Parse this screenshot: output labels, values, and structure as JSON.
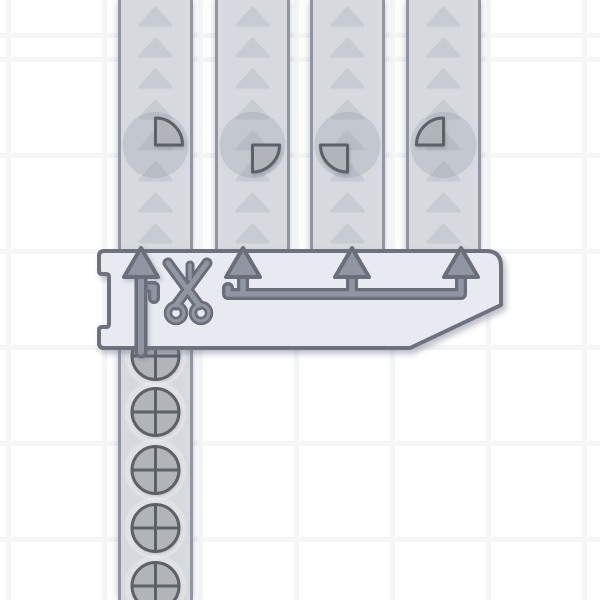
{
  "scene": {
    "title": "shape-factory-quad-cutter",
    "building": {
      "type": "quad-cutter",
      "icon": "scissors-icon",
      "inputs": 1,
      "outputs": 4,
      "x": 99,
      "y": 251,
      "right": 501,
      "bottom": 348,
      "chamfer_x": 410,
      "chamfer_y": 305,
      "notch_top_y": 274,
      "notch_bottom_y": 327,
      "notch_depth_x": 109,
      "input_x": 141,
      "output_xs": [
        243,
        352,
        461
      ],
      "line_y": 294,
      "arrow_tip_y": 248,
      "arrow_base_y": 274,
      "arrow_half_width": 17
    },
    "belts": {
      "belt_width": 75,
      "top_belts": [
        {
          "x": 118,
          "item": {
            "type": "quarter",
            "quadrant": "top-right"
          }
        },
        {
          "x": 215,
          "item": {
            "type": "quarter",
            "quadrant": "bottom-right"
          }
        },
        {
          "x": 310,
          "item": {
            "type": "quarter",
            "quadrant": "bottom-left"
          }
        },
        {
          "x": 406,
          "item": {
            "type": "quarter",
            "quadrant": "top-left"
          }
        }
      ],
      "top_belt_height": 252,
      "top_item_y": 145,
      "chevron": {
        "start_y": 8,
        "pitch": 31,
        "half_width": 15.5,
        "height": 17
      },
      "bottom_belt": {
        "x": 118,
        "top": 344,
        "height": 256,
        "item_type": "circle-cross",
        "item_center_x": 155.5,
        "item_ys": [
          356,
          412,
          470,
          528,
          586
        ]
      }
    },
    "items": {
      "quarter_radius": 27,
      "ghost_radius_top": 33,
      "circle_radius": 23.5,
      "ghost_radius_bottom": 31
    },
    "colors": {
      "background": "#ffffff",
      "grid_line": "#f4f5f7",
      "belt_bg": "#d6d9de",
      "belt_border": "#9197a2",
      "chevron": "#c7cbd2",
      "body_fill": "#e7eaf0",
      "body_stroke": "#6d727e",
      "metal_fill": "#9096a2",
      "metal_stroke": "#696e7a",
      "shape_fill": "#b1b5b9",
      "shape_stroke": "#5c6167",
      "ghost_top": "rgba(100,110,128,0.16)",
      "ghost_bottom": "rgba(255,255,255,0.22)"
    }
  }
}
